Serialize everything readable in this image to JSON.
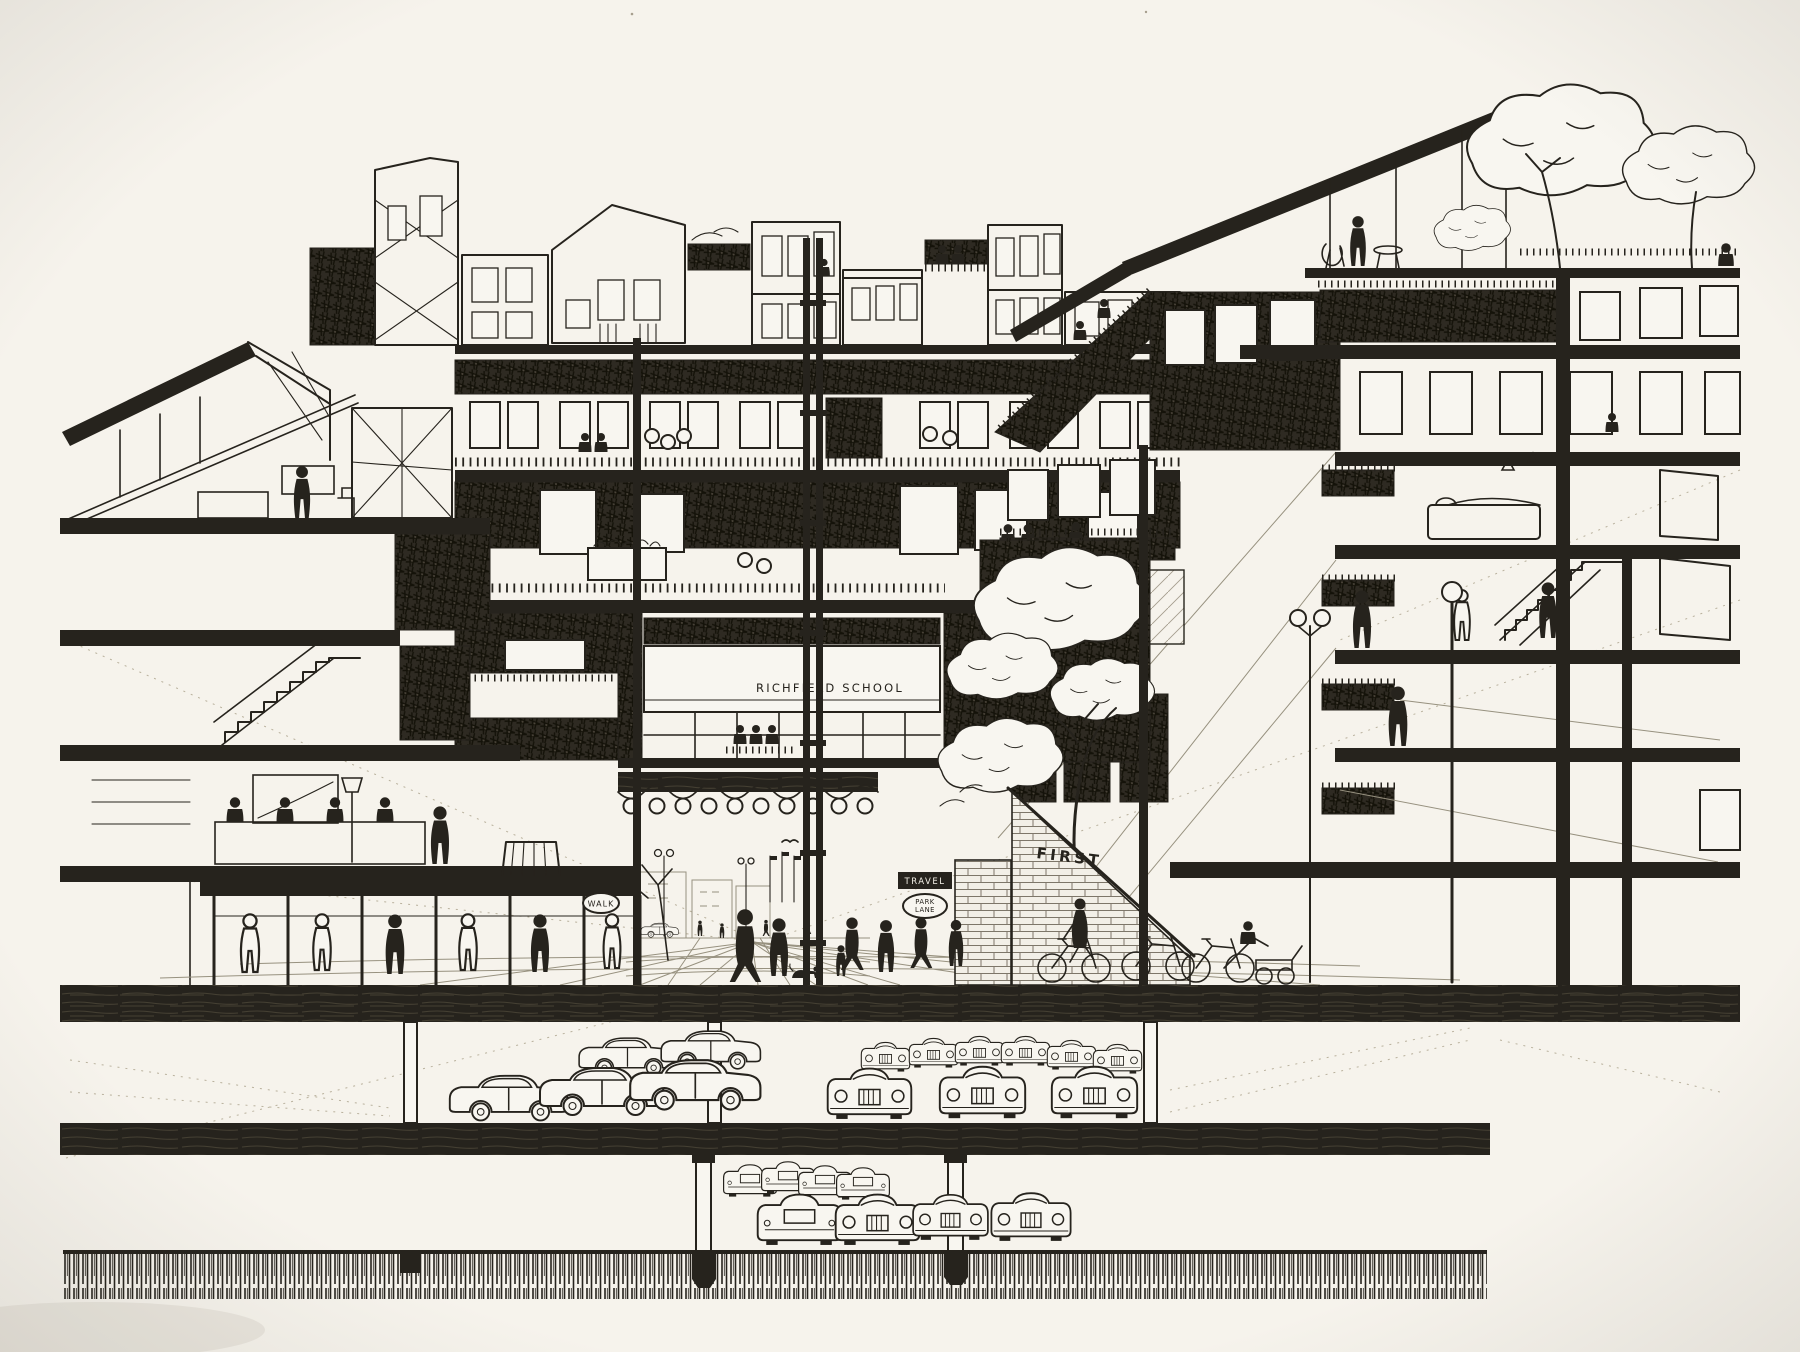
{
  "artwork": {
    "description": "Pen-and-ink sectional perspective drawing of a multi-level urban megastructure: rooftop penthouses and roof-garden terraces, stepped apartment balconies, a school level, a covered pedestrian shopping street at grade, and two basement parking levels full of cars above a hatched foundation band.",
    "signs": {
      "school": "RICHFIELD SCHOOL",
      "walk": "WALK",
      "travel": "TRAVEL",
      "park_line1": "PARK",
      "park_line2": "LANE",
      "first": "FIRST"
    },
    "colors": {
      "paper": "#f6f3ec",
      "ink": "#26231d"
    }
  }
}
